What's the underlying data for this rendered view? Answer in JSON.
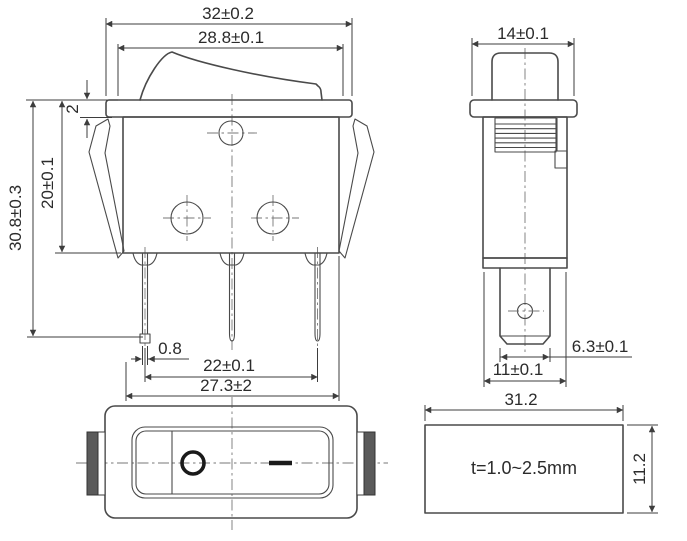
{
  "drawing": {
    "title": "rocker-switch-dimension-drawing",
    "front_view": {
      "overall_width": "32±0.2",
      "rocker_width": "28.8±0.1",
      "flange_thickness": "2",
      "body_height": "20±0.1",
      "overall_height": "30.8±0.3",
      "pin_width": "0.8",
      "pin_spacing": "22±0.1",
      "lower_span": "27.3±2"
    },
    "side_view": {
      "width": "14±0.1",
      "terminal_width": "6.3±0.1",
      "body_depth": "11±0.1"
    },
    "top_view": {
      "off_symbol": "circle-O",
      "on_symbol": "dash"
    },
    "panel_cutout": {
      "width": "31.2",
      "height": "11.2",
      "panel_thickness_note": "t=1.0~2.5mm"
    },
    "colors": {
      "outline": "#4a4a4a",
      "dimension": "#3d3d3d",
      "centerline": "#777777",
      "text": "#2b2b2b",
      "clip_fill": "#5a5a5a",
      "background": "#ffffff"
    }
  }
}
